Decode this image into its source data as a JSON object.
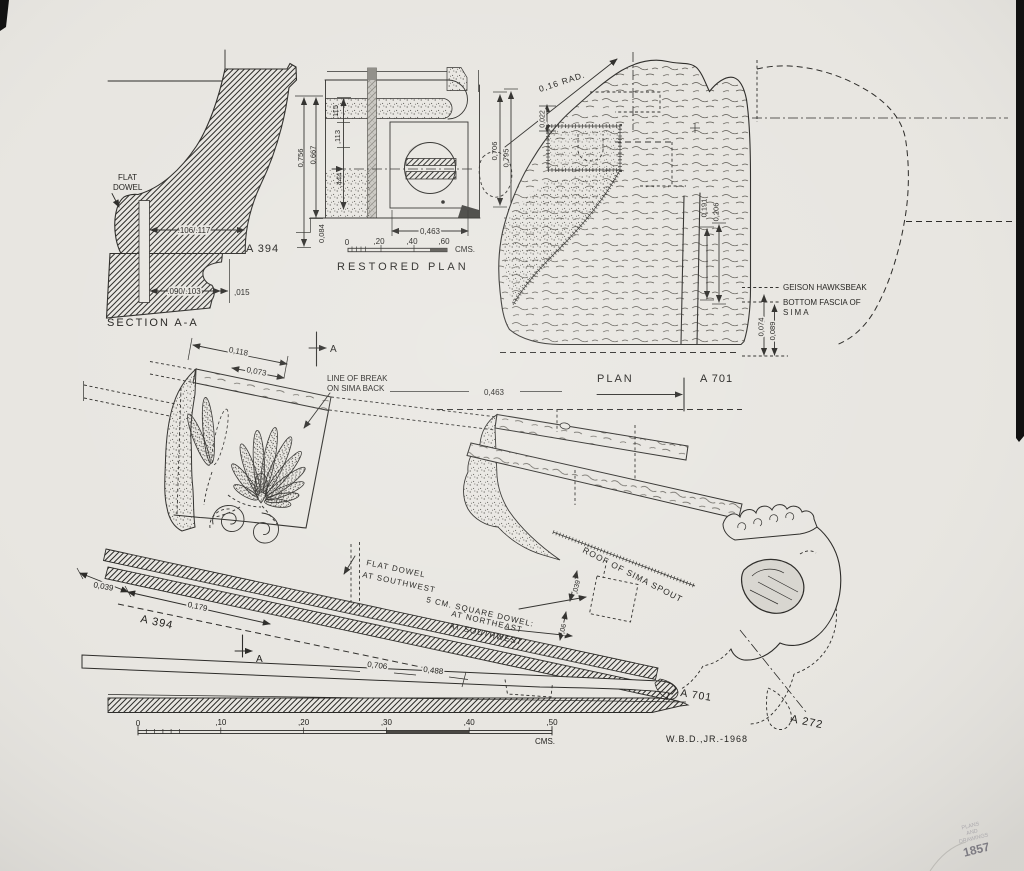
{
  "colors": {
    "paper": "#e8e6e1",
    "ink": "#2c2b28",
    "stamp": "#8f8c98"
  },
  "credit": "W.B.D.,JR.-1968",
  "section_aa": {
    "title": "SECTION A-A",
    "catalog": "A 394",
    "flat_dowel_1": "FLAT",
    "flat_dowel_2": "DOWEL",
    "dim_face": ".106/.117",
    "dim_bottom": ".090/.103",
    "dim_offset": ",015",
    "dim_height_outer": "0,756",
    "dim_height_inner": "0,667"
  },
  "restored_plan": {
    "title": "RESTORED PLAN",
    "dim_115": ",115",
    "dim_113": ",113",
    "dim_444": ",444",
    "dim_084": "0,084",
    "dim_463": "0,463",
    "dim_706": "0,706",
    "dim_795": "0,795",
    "scale": {
      "t0": "0",
      "t20": ",20",
      "t40": ",40",
      "t60": ",60",
      "unit": "CMS."
    }
  },
  "plan": {
    "title": "PLAN",
    "catalog": "A 701",
    "dim_radius": "0,16 RAD.",
    "dim_022": "0,022",
    "dim_191": "0,191",
    "dim_206": "0,206",
    "dim_074": "0,074",
    "dim_089": "0,089",
    "note_hawksbeak": "GEISON HAWKSBEAK",
    "note_fascia_1": "BOTTOM FASCIA OF",
    "note_fascia_2": "SIMA"
  },
  "elevation": {
    "catalog_sima": "A 394",
    "catalog_geison": "A 701",
    "catalog_spout": "A 272",
    "section_marker": "A",
    "dim_118": "0,118",
    "dim_073": "0,073",
    "dim_039": "0,039",
    "dim_179": "0,179",
    "dim_463": "0,463",
    "dim_706": "0,706",
    "dim_488": "0,488",
    "dim_small_039": ",039",
    "dim_small_06": ",06",
    "note_break_1": "LINE OF BREAK",
    "note_break_2": "ON SIMA BACK",
    "note_flat_dowel_1": "FLAT DOWEL",
    "note_flat_dowel_2": "AT SOUTHWEST",
    "note_square_dowel_1": "5 CM. SQUARE DOWEL:",
    "note_square_dowel_2": "AT NORTHEAST",
    "note_square_dowel_3": "AT SOUTHWEST",
    "note_roof": "ROOF OF SIMA SPOUT"
  },
  "main_scale": {
    "t0": "0",
    "t10": ",10",
    "t20": ",20",
    "t30": ",30",
    "t40": ",40",
    "t50": ",50",
    "unit": "CMS."
  },
  "stamp": {
    "ring_top": "AGORA EXCAVATIONS",
    "ring_bottom": "* ATHENS *",
    "line_1": "PLANS",
    "line_2": "AND",
    "line_3": "DRAWINGS",
    "number": "1857"
  }
}
